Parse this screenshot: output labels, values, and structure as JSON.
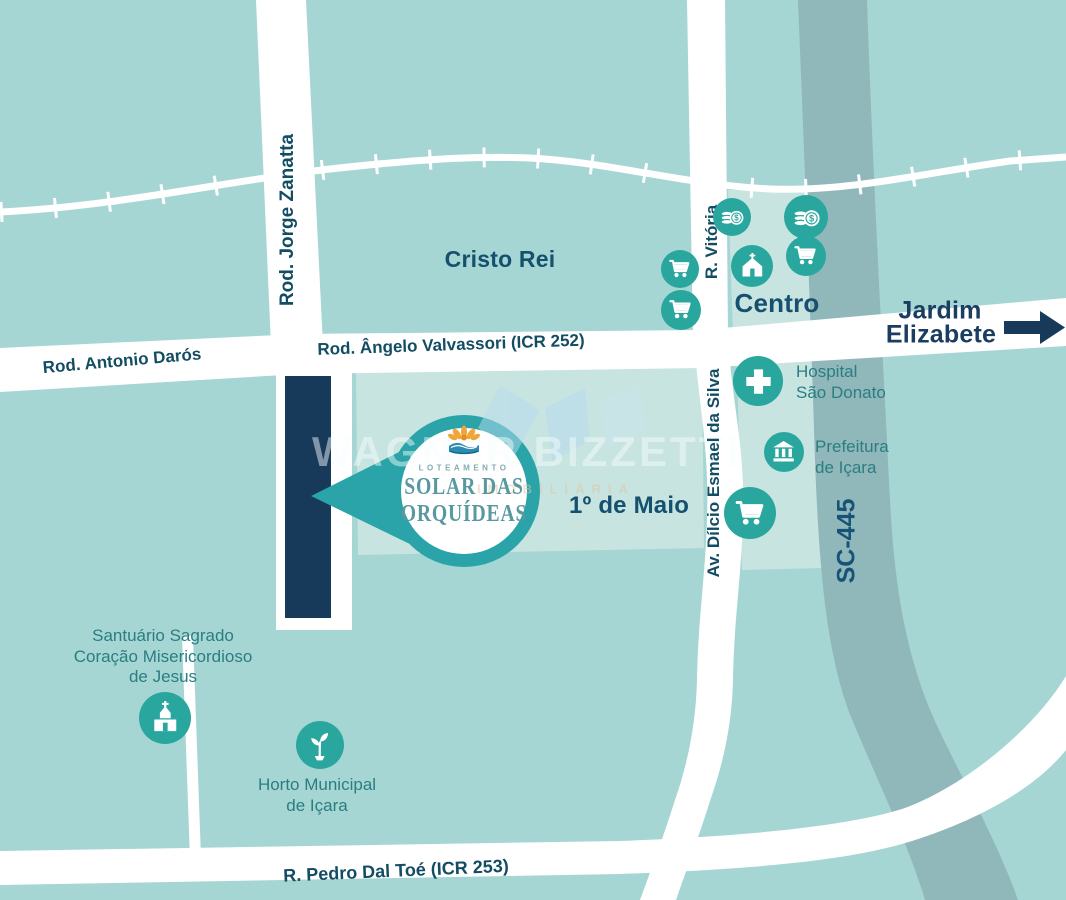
{
  "map": {
    "neighborhoods": {
      "cristo_rei": "Cristo Rei",
      "centro": "Centro",
      "jardim_l1": "Jardim",
      "jardim_l2": "Elizabete",
      "primeiro_maio": "1º de Maio"
    },
    "roads": {
      "jorge_zanatta": "Rod. Jorge Zanatta",
      "antonio_daros": "Rod. Antonio Darós",
      "angelo_valvassori": "Rod. Ângelo Valvassori (ICR 252)",
      "vitoria": "R. Vitória",
      "dilcio": "Av. Dílcio Esmael da Silva",
      "sc445": "SC-445",
      "pedro_dal_toe": "R. Pedro Dal Toé  (ICR 253)"
    },
    "landmarks": {
      "hospital_l1": "Hospital",
      "hospital_l2": "São Donato",
      "prefeitura_l1": "Prefeitura",
      "prefeitura_l2": "de Içara",
      "horto_l1": "Horto Municipal",
      "horto_l2": "de Içara",
      "santuario_l1": "Santuário Sagrado",
      "santuario_l2": "Coração Misericordioso",
      "santuario_l3": "de Jesus"
    },
    "logo": {
      "tag": "LOTEAMENTO",
      "name_l1": "SOLAR DAS",
      "name_l2": "ORQUÍDEAS"
    },
    "watermark": {
      "name": "WAGNER BIZZETTI",
      "sub": "IMOBILIÁRIA"
    },
    "colors": {
      "background": "#a6d6d3",
      "block_light": "#c7e4e1",
      "road_white": "#ffffff",
      "highway_gray": "#90b8bb",
      "plot_navy": "#17395a",
      "icon_teal": "#29a79e",
      "pin_teal": "#2aa3a9",
      "label_teal": "#2a7e81",
      "label_navy": "#124d63"
    }
  }
}
